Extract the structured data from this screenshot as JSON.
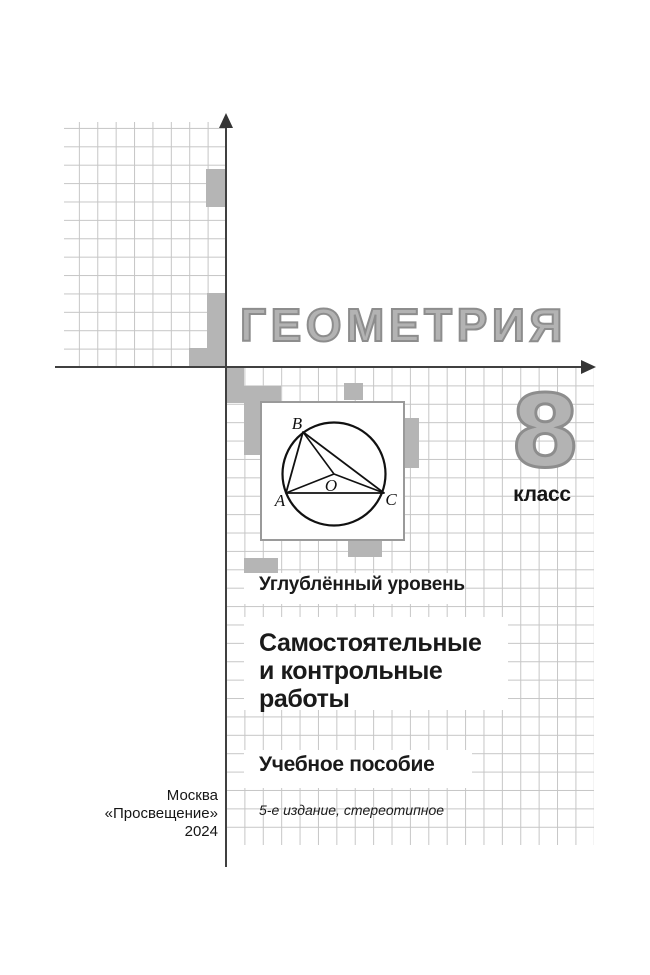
{
  "cover": {
    "title": "ГЕОМЕТРИЯ",
    "grade": {
      "number": "8",
      "label": "класс"
    },
    "level": "Углублённый уровень",
    "subtitle_lines": [
      "Самостоятельные",
      "и контрольные",
      "работы"
    ],
    "book_type": "Учебное пособие",
    "edition_note": "5-е издание, стереотипное",
    "imprint_lines": [
      "Москва",
      "«Просвещение»",
      "2024"
    ]
  },
  "figure": {
    "vertex_a": "A",
    "vertex_b": "B",
    "vertex_c": "C",
    "center": "O"
  },
  "colors": {
    "title_fill": "#b3b3b3",
    "title_outline": "#8d8d8d",
    "grid_line": "#c6c6c6",
    "grid_cell_fill": "#b5b5b5",
    "axis": "#404040",
    "text": "#1a1a1a"
  }
}
